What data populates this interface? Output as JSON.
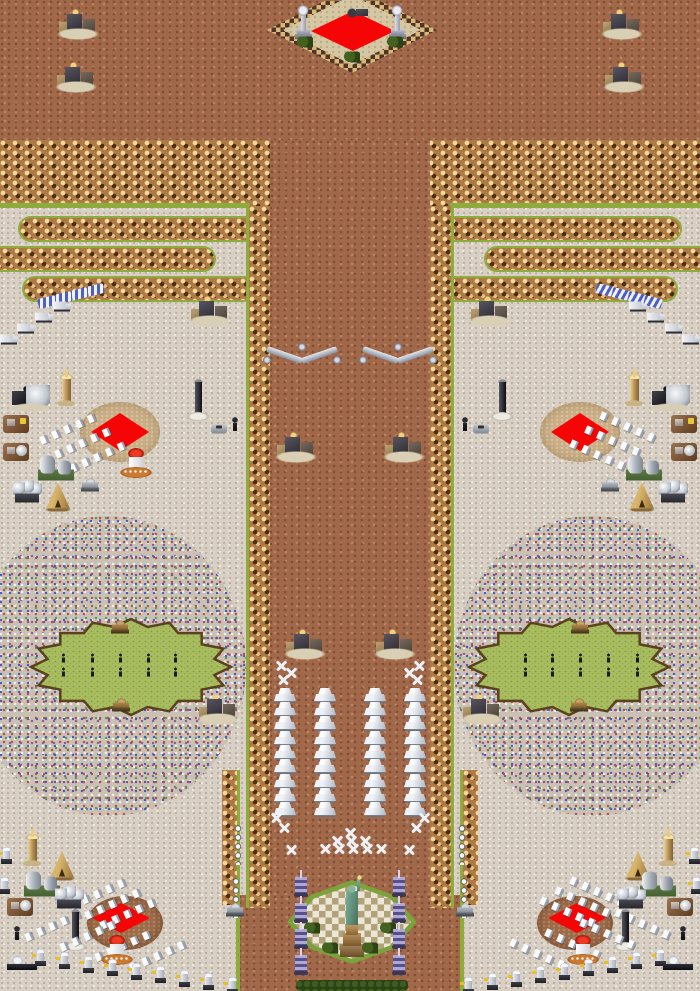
{
  "meta": {
    "title": "Isometric RTS battle map (mirror-symmetric)",
    "width": 700,
    "height": 991
  },
  "palette": {
    "dirt": "#a1694a",
    "sand": "#d8d0c4",
    "cliff_light": "#f2d89c",
    "cliff_dark": "#4e2d10",
    "grass_edge": "#8dac3c",
    "oval_fill": "#a9bd60",
    "oval_border": "#5a421e",
    "ore_red": "#f50505",
    "circle_tan": "#c9ae86",
    "circle_brown": "#9c6c4a",
    "confetti_base": "#c9c2b4",
    "statue_teal": "#6aa187",
    "tesla_purple": "#8a82b8"
  },
  "map": {
    "width": 700,
    "height": 991,
    "regions": [
      {
        "name": "dirt-plateau-top",
        "kind": "dirt",
        "x": 0,
        "y": 0,
        "w": 700,
        "h": 206
      },
      {
        "name": "sand-flats",
        "kind": "sand",
        "x": 0,
        "y": 206,
        "w": 700,
        "h": 785
      },
      {
        "name": "cliff-band-left",
        "kind": "cliff",
        "x": 0,
        "y": 140,
        "w": 272,
        "h": 66
      },
      {
        "name": "cliff-band-right",
        "kind": "cliff",
        "x": 428,
        "y": 140,
        "w": 272,
        "h": 66
      },
      {
        "name": "corridor-neck",
        "kind": "dirt",
        "x": 270,
        "y": 140,
        "w": 160,
        "h": 68
      },
      {
        "name": "corridor-main",
        "kind": "dirt",
        "x": 248,
        "y": 206,
        "w": 204,
        "h": 785
      },
      {
        "name": "corridor-bottom-spread",
        "kind": "dirt",
        "x": 238,
        "y": 895,
        "w": 224,
        "h": 96
      },
      {
        "name": "grass-line-left",
        "kind": "green",
        "x": 0,
        "y": 203,
        "w": 250,
        "h": 5
      },
      {
        "name": "grass-line-right",
        "kind": "green",
        "x": 450,
        "y": 203,
        "w": 250,
        "h": 5
      },
      {
        "name": "maze-bar-left-1",
        "kind": "bar",
        "cap": "left",
        "x": 18,
        "y": 216,
        "w": 234,
        "h": 26
      },
      {
        "name": "maze-bar-left-2",
        "kind": "bar",
        "cap": "right",
        "x": -12,
        "y": 246,
        "w": 228,
        "h": 26
      },
      {
        "name": "maze-bar-left-3",
        "kind": "bar",
        "cap": "left",
        "x": 22,
        "y": 276,
        "w": 230,
        "h": 26
      },
      {
        "name": "maze-bar-right-1",
        "kind": "bar",
        "cap": "right",
        "x": 448,
        "y": 216,
        "w": 234,
        "h": 26
      },
      {
        "name": "maze-bar-right-2",
        "kind": "bar",
        "cap": "left",
        "x": 484,
        "y": 246,
        "w": 228,
        "h": 26
      },
      {
        "name": "maze-bar-right-3",
        "kind": "bar",
        "cap": "right",
        "x": 448,
        "y": 276,
        "w": 230,
        "h": 26
      },
      {
        "name": "rubble-field-left",
        "kind": "confetti",
        "x": -30,
        "y": 516,
        "w": 276,
        "h": 300
      },
      {
        "name": "rubble-field-right",
        "kind": "confetti",
        "x": 454,
        "y": 516,
        "w": 276,
        "h": 300
      },
      {
        "name": "corridor-edge-left",
        "kind": "edge",
        "green": "left",
        "x": 246,
        "y": 206,
        "w": 24,
        "h": 702
      },
      {
        "name": "corridor-edge-right",
        "kind": "edge",
        "green": "right",
        "x": 430,
        "y": 206,
        "w": 24,
        "h": 702
      },
      {
        "name": "corridor-flare-left",
        "kind": "edge",
        "green": "right",
        "x": 222,
        "y": 770,
        "w": 18,
        "h": 135
      },
      {
        "name": "corridor-flare-right",
        "kind": "edge",
        "green": "left",
        "x": 460,
        "y": 770,
        "w": 18,
        "h": 135
      },
      {
        "name": "ore-circle-mid-left",
        "kind": "circle-tan",
        "x": 80,
        "y": 402,
        "w": 80,
        "h": 60
      },
      {
        "name": "ore-circle-mid-right",
        "kind": "circle-tan",
        "x": 540,
        "y": 402,
        "w": 80,
        "h": 60
      },
      {
        "name": "ore-diamond-mid-left",
        "kind": "diamond",
        "x": 91,
        "y": 413,
        "w": 58,
        "h": 38
      },
      {
        "name": "ore-diamond-mid-right",
        "kind": "diamond",
        "x": 551,
        "y": 413,
        "w": 58,
        "h": 38
      },
      {
        "name": "ore-circle-bottom-left",
        "kind": "circle-brown",
        "x": 87,
        "y": 896,
        "w": 76,
        "h": 54
      },
      {
        "name": "ore-circle-bottom-right",
        "kind": "circle-brown",
        "x": 537,
        "y": 896,
        "w": 76,
        "h": 54
      },
      {
        "name": "ore-diamond-bottom-left",
        "kind": "diamond",
        "x": 92,
        "y": 903,
        "w": 58,
        "h": 30
      },
      {
        "name": "ore-diamond-bottom-right",
        "kind": "diamond",
        "x": 548,
        "y": 903,
        "w": 58,
        "h": 30
      },
      {
        "name": "top-plaza-rim",
        "kind": "plaza-top-outer",
        "x": 267,
        "y": -13,
        "w": 170,
        "h": 86
      },
      {
        "name": "top-plaza-field",
        "kind": "plaza-top-inner",
        "x": 283,
        "y": -5,
        "w": 138,
        "h": 70
      },
      {
        "name": "top-plaza-red-carpet",
        "kind": "diamond",
        "x": 311,
        "y": 11,
        "w": 84,
        "h": 40
      },
      {
        "name": "statue-plaza-rim",
        "kind": "plaza-statue-outer",
        "x": 287,
        "y": 880,
        "w": 130,
        "h": 84
      },
      {
        "name": "statue-plaza-mosaic",
        "kind": "plaza-statue-inner",
        "x": 293,
        "y": 885,
        "w": 118,
        "h": 74
      },
      {
        "name": "grass-line-bottom-left",
        "kind": "green",
        "x": 236,
        "y": 900,
        "w": 4,
        "h": 91
      },
      {
        "name": "grass-line-bottom-right",
        "kind": "green",
        "x": 460,
        "y": 900,
        "w": 4,
        "h": 91
      },
      {
        "name": "hedge-row-bottom",
        "kind": "hedge",
        "x": 296,
        "y": 980,
        "w": 112,
        "h": 11
      }
    ],
    "ovals": [
      {
        "name": "parade-ground-left",
        "cx": 131,
        "cy": 667,
        "rx": 100,
        "ry": 48,
        "teeth": 16
      },
      {
        "name": "parade-ground-right",
        "cx": 569,
        "cy": 667,
        "rx": 100,
        "ry": 48,
        "teeth": 16
      }
    ],
    "objects": [
      {
        "t": "ruin",
        "x": 78,
        "y": 25,
        "m": 1
      },
      {
        "t": "ruin",
        "x": 76,
        "y": 78,
        "m": 1
      },
      {
        "t": "monu",
        "x": 303,
        "y": 22,
        "m": 1
      },
      {
        "t": "wreck",
        "x": 358,
        "y": 12
      },
      {
        "t": "bush",
        "x": 305,
        "y": 42,
        "m": 1
      },
      {
        "t": "bush",
        "x": 352,
        "y": 57
      },
      {
        "t": "barricade",
        "x": 95,
        "y": 290,
        "m": 1
      },
      {
        "t": "barricade",
        "x": 79,
        "y": 294,
        "m": 1
      },
      {
        "t": "barricade",
        "x": 63,
        "y": 298,
        "m": 1
      },
      {
        "t": "barricade",
        "x": 47,
        "y": 302,
        "m": 1
      },
      {
        "t": "truck",
        "x": 62,
        "y": 306,
        "m": 1
      },
      {
        "t": "truck",
        "x": 44,
        "y": 317,
        "m": 1
      },
      {
        "t": "truck",
        "x": 26,
        "y": 328,
        "m": 1
      },
      {
        "t": "truck",
        "x": 9,
        "y": 339,
        "m": 1
      },
      {
        "t": "ruin",
        "x": 210,
        "y": 312,
        "m": 1
      },
      {
        "t": "tower-tan",
        "x": 66,
        "y": 388,
        "m": 1
      },
      {
        "t": "dome-machine",
        "x": 30,
        "y": 398,
        "m": 1
      },
      {
        "t": "obelisk",
        "x": 198,
        "y": 400,
        "m": 1
      },
      {
        "t": "plot",
        "v": "yellow",
        "x": 16,
        "y": 424,
        "m": 1
      },
      {
        "t": "pawn",
        "x": 235,
        "y": 424,
        "m": 1
      },
      {
        "t": "car",
        "x": 219,
        "y": 429,
        "m": 1
      },
      {
        "t": "crystal-row",
        "x": 70,
        "y": 428,
        "m": 1
      },
      {
        "t": "crystal-row",
        "x": 85,
        "y": 442,
        "m": 1
      },
      {
        "t": "crystal-row",
        "x": 100,
        "y": 456,
        "m": 1
      },
      {
        "t": "plot",
        "v": "dish",
        "x": 16,
        "y": 452,
        "m": 1
      },
      {
        "t": "pod-red",
        "x": 136,
        "y": 463
      },
      {
        "t": "nuke",
        "x": 56,
        "y": 468,
        "m": 1
      },
      {
        "t": "tank",
        "x": 90,
        "y": 485,
        "m": 1
      },
      {
        "t": "sphere-cluster",
        "x": 27,
        "y": 492,
        "m": 1
      },
      {
        "t": "teepee",
        "x": 58,
        "y": 497,
        "m": 1
      },
      {
        "t": "wall-chevron",
        "x": 302,
        "y": 356,
        "m": 1
      },
      {
        "t": "ruin",
        "x": 296,
        "y": 448,
        "m": 1
      },
      {
        "t": "tank",
        "v": "brown",
        "x": 120,
        "y": 627,
        "m": 1
      },
      {
        "t": "soldier",
        "x": 63,
        "y": 658,
        "m": 1
      },
      {
        "t": "soldier",
        "x": 92,
        "y": 658,
        "m": 1
      },
      {
        "t": "soldier",
        "x": 120,
        "y": 658,
        "m": 1
      },
      {
        "t": "soldier",
        "x": 148,
        "y": 658,
        "m": 1
      },
      {
        "t": "soldier",
        "x": 175,
        "y": 658,
        "m": 1
      },
      {
        "t": "soldier",
        "x": 63,
        "y": 672,
        "m": 1
      },
      {
        "t": "soldier",
        "x": 92,
        "y": 672,
        "m": 1
      },
      {
        "t": "soldier",
        "x": 120,
        "y": 672,
        "m": 1
      },
      {
        "t": "soldier",
        "x": 148,
        "y": 672,
        "m": 1
      },
      {
        "t": "soldier",
        "x": 175,
        "y": 672,
        "m": 1
      },
      {
        "t": "tank",
        "v": "brown",
        "x": 121,
        "y": 705,
        "m": 1
      },
      {
        "t": "ruin",
        "x": 218,
        "y": 710,
        "m": 1
      },
      {
        "t": "ruin",
        "x": 305,
        "y": 645,
        "m": 1
      },
      {
        "t": "plane",
        "x": 281,
        "y": 666,
        "m": 1
      },
      {
        "t": "plane",
        "x": 291,
        "y": 673,
        "m": 1
      },
      {
        "t": "plane",
        "x": 283,
        "y": 680,
        "m": 1
      },
      {
        "t": "tent",
        "x": 285,
        "y": 696,
        "m": 1
      },
      {
        "t": "tent",
        "x": 285,
        "y": 710,
        "m": 1
      },
      {
        "t": "tent",
        "x": 285,
        "y": 724,
        "m": 1
      },
      {
        "t": "tent",
        "x": 285,
        "y": 739,
        "m": 1
      },
      {
        "t": "tent",
        "x": 285,
        "y": 753,
        "m": 1
      },
      {
        "t": "tent",
        "x": 285,
        "y": 767,
        "m": 1
      },
      {
        "t": "tent",
        "x": 285,
        "y": 782,
        "m": 1
      },
      {
        "t": "tent",
        "x": 285,
        "y": 796,
        "m": 1
      },
      {
        "t": "tent",
        "x": 285,
        "y": 810,
        "m": 1
      },
      {
        "t": "tent",
        "x": 325,
        "y": 696,
        "m": 1
      },
      {
        "t": "tent",
        "x": 325,
        "y": 710,
        "m": 1
      },
      {
        "t": "tent",
        "x": 325,
        "y": 724,
        "m": 1
      },
      {
        "t": "tent",
        "x": 325,
        "y": 739,
        "m": 1
      },
      {
        "t": "tent",
        "x": 325,
        "y": 753,
        "m": 1
      },
      {
        "t": "tent",
        "x": 325,
        "y": 767,
        "m": 1
      },
      {
        "t": "tent",
        "x": 325,
        "y": 782,
        "m": 1
      },
      {
        "t": "tent",
        "x": 325,
        "y": 796,
        "m": 1
      },
      {
        "t": "tent",
        "x": 325,
        "y": 810,
        "m": 1
      },
      {
        "t": "unit-stack",
        "x": 238,
        "y": 845,
        "m": 1
      },
      {
        "t": "unit-stack",
        "x": 236,
        "y": 898,
        "m": 1
      },
      {
        "t": "plane",
        "x": 276,
        "y": 818,
        "m": 1
      },
      {
        "t": "plane",
        "x": 284,
        "y": 828,
        "m": 1
      },
      {
        "t": "plane",
        "x": 291,
        "y": 850,
        "m": 1
      },
      {
        "t": "plane",
        "x": 350,
        "y": 833
      },
      {
        "t": "plane",
        "x": 337,
        "y": 841
      },
      {
        "t": "plane",
        "x": 351,
        "y": 841
      },
      {
        "t": "plane",
        "x": 365,
        "y": 841
      },
      {
        "t": "plane",
        "x": 325,
        "y": 849
      },
      {
        "t": "plane",
        "x": 339,
        "y": 849
      },
      {
        "t": "plane",
        "x": 353,
        "y": 849
      },
      {
        "t": "plane",
        "x": 367,
        "y": 849
      },
      {
        "t": "plane",
        "x": 381,
        "y": 849
      },
      {
        "t": "turret",
        "x": 6,
        "y": 856,
        "m": 1
      },
      {
        "t": "turret",
        "x": 4,
        "y": 886,
        "m": 1
      },
      {
        "t": "tower-tan",
        "x": 32,
        "y": 848,
        "m": 1
      },
      {
        "t": "teepee",
        "x": 62,
        "y": 866,
        "m": 1
      },
      {
        "t": "nuke",
        "x": 42,
        "y": 884,
        "m": 1
      },
      {
        "t": "sphere-cluster",
        "x": 69,
        "y": 898,
        "m": 1
      },
      {
        "t": "crystal-row",
        "x": 100,
        "y": 893,
        "m": 1
      },
      {
        "t": "crystal-row",
        "x": 115,
        "y": 903,
        "m": 1
      },
      {
        "t": "crystal-row",
        "x": 130,
        "y": 913,
        "m": 1
      },
      {
        "t": "plot",
        "v": "dish",
        "x": 20,
        "y": 907,
        "m": 1
      },
      {
        "t": "tank",
        "x": 235,
        "y": 910,
        "m": 1
      },
      {
        "t": "obelisk",
        "x": 75,
        "y": 930,
        "m": 1
      },
      {
        "t": "pawn",
        "x": 17,
        "y": 933,
        "m": 1
      },
      {
        "t": "crystal-row",
        "x": 55,
        "y": 925,
        "m": 1
      },
      {
        "t": "crystal-row",
        "x": 90,
        "y": 935,
        "m": 1
      },
      {
        "t": "crystal-row",
        "x": 125,
        "y": 945,
        "m": 1
      },
      {
        "t": "crystal-row",
        "x": 160,
        "y": 955,
        "m": 1
      },
      {
        "t": "pod-red",
        "x": 117,
        "y": 950,
        "m": 1
      },
      {
        "t": "boat",
        "x": 22,
        "y": 963,
        "m": 1
      },
      {
        "t": "turret",
        "x": 40,
        "y": 958,
        "m": 1
      },
      {
        "t": "turret",
        "x": 64,
        "y": 961,
        "m": 1
      },
      {
        "t": "turret",
        "x": 88,
        "y": 965,
        "m": 1
      },
      {
        "t": "turret",
        "x": 112,
        "y": 968,
        "m": 1
      },
      {
        "t": "turret",
        "x": 136,
        "y": 972,
        "m": 1
      },
      {
        "t": "turret",
        "x": 160,
        "y": 975,
        "m": 1
      },
      {
        "t": "turret",
        "x": 184,
        "y": 979,
        "m": 1
      },
      {
        "t": "turret",
        "x": 208,
        "y": 982,
        "m": 1
      },
      {
        "t": "turret",
        "x": 232,
        "y": 986,
        "m": 1
      },
      {
        "t": "tesla",
        "x": 301,
        "y": 884,
        "m": 1
      },
      {
        "t": "tesla",
        "x": 301,
        "y": 910,
        "m": 1
      },
      {
        "t": "tesla",
        "x": 301,
        "y": 936,
        "m": 1
      },
      {
        "t": "tesla",
        "x": 301,
        "y": 962,
        "m": 1
      },
      {
        "t": "bush",
        "x": 312,
        "y": 928,
        "m": 1
      },
      {
        "t": "bush",
        "x": 330,
        "y": 948,
        "m": 1
      },
      {
        "t": "statue",
        "x": 352,
        "y": 918
      }
    ]
  }
}
